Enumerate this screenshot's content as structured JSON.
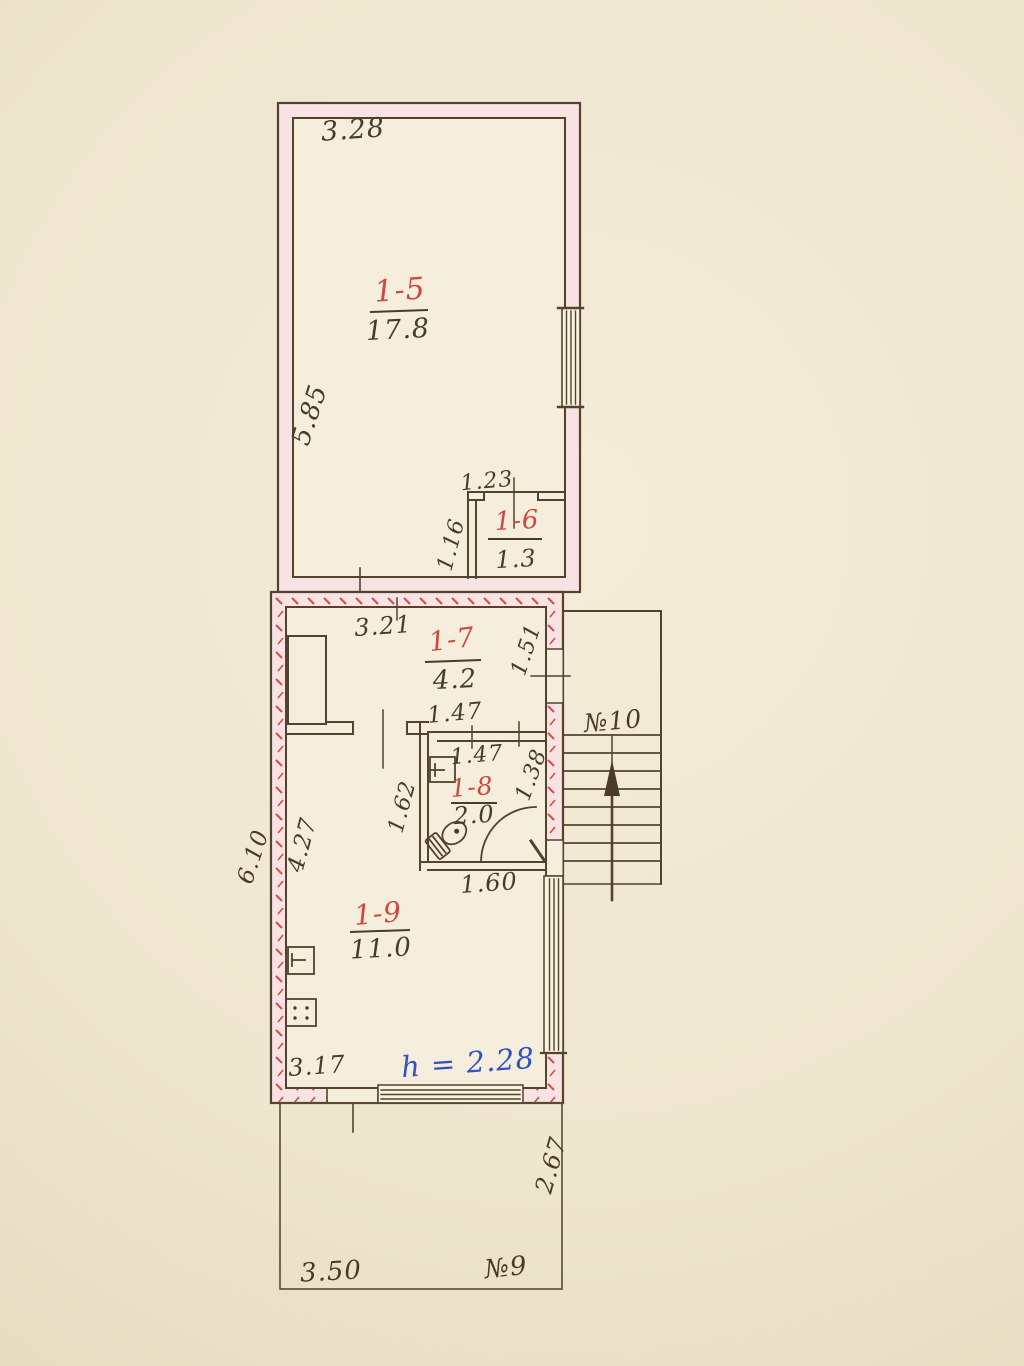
{
  "rooms": [
    {
      "label": "1-5",
      "area": "17.8"
    },
    {
      "label": "1-6",
      "area": "1.3"
    },
    {
      "label": "1-7",
      "area": "4.2"
    },
    {
      "label": "1-8",
      "area": "2.0"
    },
    {
      "label": "1-9",
      "area": "11.0"
    }
  ],
  "dimensions": {
    "r15_width": "3.28",
    "r15_depth": "5.85",
    "r16_width": "1.23",
    "r16_depth": "1.16",
    "r17_width": "3.21",
    "r17_entry": "1.51",
    "hall_width": "1.47",
    "r18_width": "1.47",
    "r18_right": "1.38",
    "r18_left": "1.62",
    "r18_bottom": "1.60",
    "r19_left": "4.27",
    "wing_depth": "6.10",
    "r19_bottom": "3.17",
    "porch_width": "3.50",
    "porch_depth": "2.67"
  },
  "notes": {
    "ceiling_height": "h = 2.28"
  },
  "labels": {
    "stairwell": "№10",
    "porch": "№9"
  },
  "colors": {
    "ink": "#4c3b27",
    "room_label_red": "#cc4a3e",
    "note_blue": "#3352c2",
    "wall_pink": "#f7e2e4",
    "hatch_red": "#d94f43",
    "paper": "#efe6d0"
  }
}
